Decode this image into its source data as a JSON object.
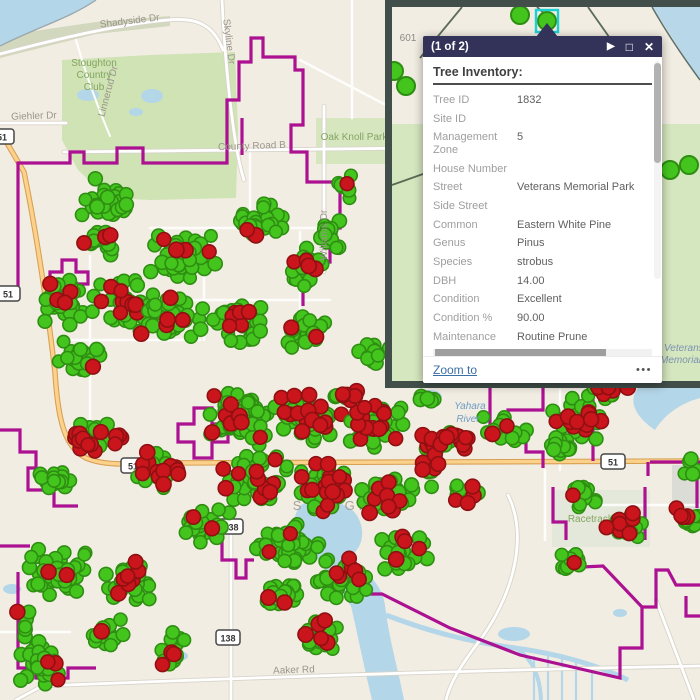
{
  "popup": {
    "pagination": "(1 of 2)",
    "next_icon": "▶",
    "maximize_icon": "□",
    "close_icon": "✕",
    "title": "Tree Inventory:",
    "fields": [
      {
        "label": "Tree ID",
        "value": "1832"
      },
      {
        "label": "Site ID",
        "value": ""
      },
      {
        "label": "Management Zone",
        "value": "5"
      },
      {
        "label": "House Number",
        "value": ""
      },
      {
        "label": "Street",
        "value": "Veterans Memorial Park"
      },
      {
        "label": "Side Street",
        "value": ""
      },
      {
        "label": "Common",
        "value": "Eastern White Pine"
      },
      {
        "label": "Genus",
        "value": "Pinus"
      },
      {
        "label": "Species",
        "value": "strobus"
      },
      {
        "label": "DBH",
        "value": "14.00"
      },
      {
        "label": "Condition",
        "value": "Excellent"
      },
      {
        "label": "Condition %",
        "value": "90.00"
      },
      {
        "label": "Maintenance",
        "value": "Routine Prune"
      }
    ],
    "zoom_to": "Zoom to",
    "more": "•••"
  },
  "map": {
    "colors": {
      "background": "#f2ede3",
      "water": "#b3d6e8",
      "park": "#cfe3b5",
      "boundary_magenta": "#ab1191",
      "highway_orange": "#fbd18c",
      "highway_casing": "#d79f52",
      "tree_green_fill": "#44c51e",
      "tree_green_stroke": "#2e8e12",
      "tree_red_fill": "#c9151b",
      "tree_red_stroke": "#8f1012",
      "selection_cyan": "#1bd0d2",
      "popup_header_navy": "#33335a",
      "inset_frame": "#414e49"
    },
    "labels": [
      {
        "text": "Shadyside Dr",
        "x": 130,
        "y": 24,
        "cls": "road",
        "rot": -7,
        "layer": "over"
      },
      {
        "text": "Skyline Dr",
        "x": 226,
        "y": 42,
        "cls": "road",
        "rot": 83,
        "layer": "over"
      },
      {
        "text": "Giehler Dr",
        "x": 34,
        "y": 119,
        "cls": "road",
        "rot": -2,
        "layer": "over"
      },
      {
        "text": "Stoughton",
        "x": 94,
        "y": 66,
        "cls": "park",
        "layer": "over"
      },
      {
        "text": "Country",
        "x": 94,
        "y": 78,
        "cls": "park",
        "layer": "over"
      },
      {
        "text": "Club",
        "x": 94,
        "y": 90,
        "cls": "park",
        "layer": "over"
      },
      {
        "text": "Linnerud Dr",
        "x": 111,
        "y": 92,
        "cls": "road",
        "rot": -75,
        "layer": "over"
      },
      {
        "text": "County Road B",
        "x": 252,
        "y": 149,
        "cls": "road",
        "rot": -2,
        "layer": "over"
      },
      {
        "text": "Oak Knoll Park",
        "x": 354,
        "y": 140,
        "cls": "park",
        "layer": "over"
      },
      {
        "text": "Williams Dr",
        "x": 327,
        "y": 235,
        "cls": "road",
        "rot": -90,
        "layer": "over"
      },
      {
        "text": "Yahara",
        "x": 470,
        "y": 409,
        "cls": "water",
        "layer": "over"
      },
      {
        "text": "River",
        "x": 468,
        "y": 422,
        "cls": "water",
        "layer": "over"
      },
      {
        "text": "STOUGHTON",
        "x": 352,
        "y": 510,
        "cls": "city",
        "layer": "under"
      },
      {
        "text": "Racetrack Park",
        "x": 602,
        "y": 522,
        "cls": "park",
        "layer": "under"
      },
      {
        "text": "Aaker Rd",
        "x": 294,
        "y": 673,
        "cls": "road",
        "rot": -2,
        "layer": "over"
      }
    ],
    "shields": [
      {
        "t": "51",
        "x": 2,
        "y": 137
      },
      {
        "t": "51",
        "x": 8,
        "y": 294
      },
      {
        "t": "51",
        "x": 133,
        "y": 466
      },
      {
        "t": "51",
        "x": 613,
        "y": 462
      },
      {
        "t": "138",
        "x": 231,
        "y": 527
      },
      {
        "t": "138",
        "x": 228,
        "y": 638
      }
    ],
    "tree_clusters": [
      [
        108,
        200,
        28,
        22,
        30,
        0.05
      ],
      [
        95,
        242,
        22,
        16,
        20,
        0.1
      ],
      [
        62,
        300,
        30,
        26,
        34,
        0.12
      ],
      [
        125,
        300,
        34,
        28,
        42,
        0.12
      ],
      [
        78,
        356,
        28,
        18,
        24,
        0.08
      ],
      [
        185,
        255,
        40,
        26,
        46,
        0.1
      ],
      [
        258,
        224,
        30,
        22,
        30,
        0.12
      ],
      [
        305,
        268,
        24,
        24,
        26,
        0.15
      ],
      [
        170,
        320,
        38,
        24,
        40,
        0.1
      ],
      [
        240,
        322,
        34,
        24,
        36,
        0.15
      ],
      [
        305,
        332,
        24,
        20,
        22,
        0.2
      ],
      [
        330,
        230,
        13,
        24,
        12,
        0.08
      ],
      [
        345,
        188,
        10,
        16,
        8,
        0.05
      ],
      [
        95,
        440,
        30,
        20,
        30,
        0.25
      ],
      [
        60,
        480,
        22,
        16,
        18,
        0.1
      ],
      [
        160,
        470,
        30,
        22,
        30,
        0.3
      ],
      [
        205,
        526,
        26,
        20,
        26,
        0.12
      ],
      [
        240,
        420,
        40,
        30,
        56,
        0.12
      ],
      [
        310,
        415,
        38,
        28,
        52,
        0.18
      ],
      [
        375,
        426,
        34,
        26,
        46,
        0.25
      ],
      [
        255,
        480,
        38,
        26,
        50,
        0.15
      ],
      [
        325,
        486,
        34,
        26,
        48,
        0.25
      ],
      [
        390,
        496,
        30,
        24,
        40,
        0.15
      ],
      [
        290,
        546,
        34,
        24,
        40,
        0.15
      ],
      [
        345,
        580,
        32,
        24,
        38,
        0.3
      ],
      [
        405,
        552,
        26,
        20,
        30,
        0.15
      ],
      [
        280,
        596,
        24,
        18,
        22,
        0.1
      ],
      [
        320,
        636,
        24,
        18,
        22,
        0.3
      ],
      [
        375,
        352,
        18,
        16,
        12,
        0.1
      ],
      [
        350,
        396,
        12,
        8,
        10,
        0.85
      ],
      [
        430,
        462,
        12,
        32,
        20,
        0.45
      ],
      [
        456,
        440,
        17,
        14,
        16,
        0.5
      ],
      [
        466,
        492,
        18,
        14,
        15,
        0.2
      ],
      [
        60,
        572,
        34,
        26,
        46,
        0.1
      ],
      [
        130,
        582,
        30,
        24,
        36,
        0.12
      ],
      [
        105,
        632,
        22,
        16,
        18,
        0.05
      ],
      [
        172,
        648,
        13,
        24,
        15,
        0.15
      ],
      [
        38,
        662,
        24,
        28,
        32,
        0.05
      ],
      [
        28,
        620,
        14,
        14,
        10,
        0.05
      ],
      [
        505,
        430,
        24,
        16,
        20,
        0.15
      ],
      [
        575,
        420,
        30,
        24,
        32,
        0.3
      ],
      [
        560,
        447,
        18,
        11,
        12,
        0.2
      ],
      [
        582,
        499,
        19,
        14,
        16,
        0.2
      ],
      [
        625,
        526,
        21,
        17,
        20,
        0.25
      ],
      [
        688,
        520,
        14,
        17,
        12,
        0.35
      ],
      [
        570,
        561,
        17,
        11,
        12,
        0.15
      ],
      [
        690,
        470,
        9,
        14,
        6,
        0.1
      ],
      [
        608,
        392,
        26,
        8,
        14,
        0.2
      ],
      [
        430,
        398,
        12,
        6,
        6,
        0.1
      ]
    ]
  },
  "inset": {
    "labels": [
      {
        "text": "601",
        "x": 408,
        "y": 41,
        "cls": "inset-lbl",
        "anchor": "middle"
      },
      {
        "text": "625",
        "x": 624,
        "y": 375,
        "cls": "inset-lbl",
        "anchor": "middle"
      },
      {
        "text": "Veterans",
        "x": 664,
        "y": 351,
        "cls": "inset-water",
        "anchor": "start"
      },
      {
        "text": "Memorial",
        "x": 660,
        "y": 363,
        "cls": "inset-water",
        "anchor": "start"
      }
    ],
    "dots": [
      {
        "x": 520,
        "y": 15
      },
      {
        "x": 547,
        "y": 21,
        "selected": true
      },
      {
        "x": 394,
        "y": 71
      },
      {
        "x": 406,
        "y": 86
      },
      {
        "x": 670,
        "y": 170
      },
      {
        "x": 689,
        "y": 165
      },
      {
        "x": 439,
        "y": 372
      },
      {
        "x": 492,
        "y": 350
      },
      {
        "x": 630,
        "y": 361
      }
    ]
  }
}
